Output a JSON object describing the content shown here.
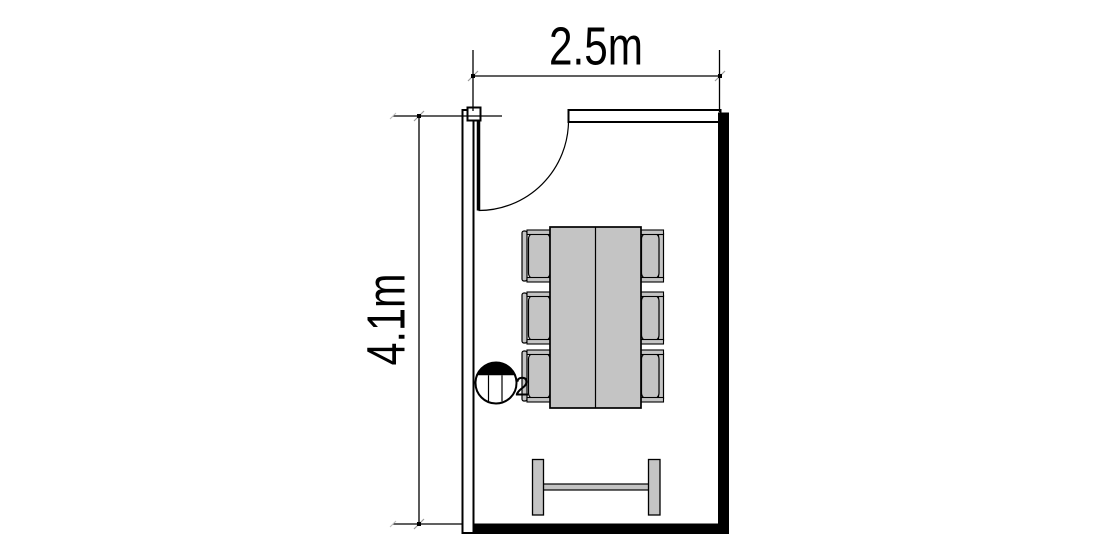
{
  "labels": {
    "width_dimension": "2.5m",
    "height_dimension": "4.1m",
    "symbol_label": "2"
  },
  "colors": {
    "background": "#ffffff",
    "line": "#000000",
    "wall_fill": "#000000",
    "furniture_fill": "#c4c4c4"
  },
  "plan": {
    "type": "floor-plan",
    "room_width_label": "2.5m",
    "room_depth_label": "4.1m",
    "chair_count": 6,
    "elements": [
      "door-with-swing-arc",
      "conference-table",
      "office-chairs",
      "bench",
      "circle-symbol"
    ]
  }
}
